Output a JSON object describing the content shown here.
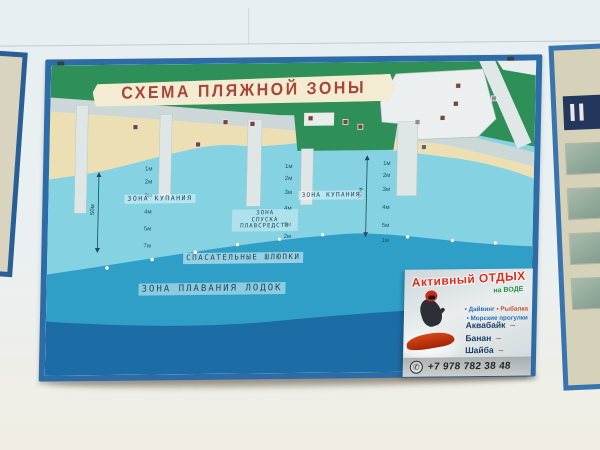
{
  "colors": {
    "wall": "#e7eff2",
    "wall_lower": "#f1ede3",
    "frame_blue": "#2e6ca8",
    "land_green": "#2e8f58",
    "sand": "#ecdfb4",
    "promenade": "#ccd7d8",
    "water_light": "#85d2e3",
    "water_mid": "#2f9fc7",
    "water_dark": "#1c6ca5",
    "banner_cream": "#f3ecd2",
    "title_red": "#a8453b",
    "label_text": "#1d4a60",
    "ad_title_red": "#e02b18",
    "ad_green": "#1f8c3c",
    "ad_navy": "#1d3f66"
  },
  "sign": {
    "title": "СХЕМА ПЛЯЖНОЙ ЗОНЫ"
  },
  "map": {
    "zones": {
      "swim_left": "ЗОНА КУПАНИЯ",
      "swim_right": "ЗОНА КУПАНИЯ",
      "launch_line1": "ЗОНА",
      "launch_line2": "СПУСКА",
      "launch_line3": "ПЛАВСРЕДСТВ",
      "lifeboats": "СПАСАТЕЛЬНЫЕ ШЛЮПКИ",
      "boats": "ЗОНА ПЛАВАНИЯ ЛОДОК"
    },
    "distance_markers": [
      "50м",
      "50м"
    ],
    "depth_columns": [
      {
        "labels": [
          "1м",
          "2м",
          "3м",
          "4м",
          "5м",
          "7м"
        ]
      },
      {
        "labels": [
          "1м",
          "2м",
          "3м",
          "4м",
          "5м",
          "2м"
        ]
      },
      {
        "labels": [
          "1м",
          "2м",
          "3м",
          "4м",
          "5м",
          "1м"
        ]
      }
    ]
  },
  "ad": {
    "title": "Активный ОТДЫХ",
    "subtitle": "на ВОДЕ",
    "services_line1": [
      "• Дайвинг",
      "• Рыбалка"
    ],
    "services_line2": "• Морские прогулки",
    "price_items": [
      "Аквабайк",
      "Банан",
      "Шайба"
    ],
    "price_separator": "–",
    "phone": "+7 978 782 38 48"
  }
}
